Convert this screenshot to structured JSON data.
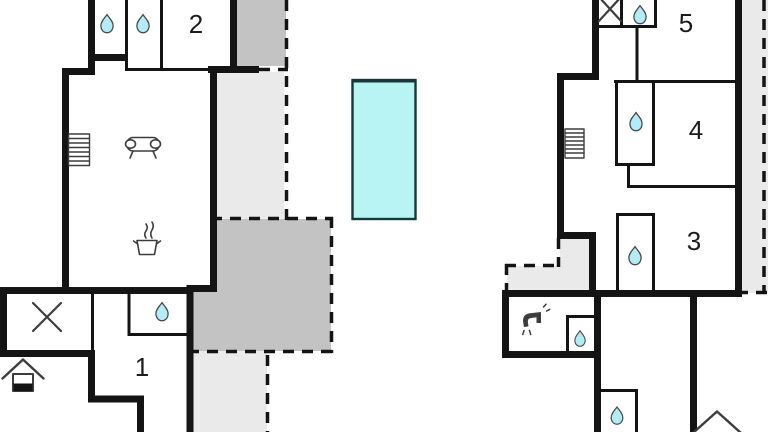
{
  "plan": {
    "rooms": [
      {
        "number": "1"
      },
      {
        "number": "2"
      },
      {
        "number": "3"
      },
      {
        "number": "4"
      },
      {
        "number": "5"
      }
    ],
    "icons": {
      "water-drop-icon": "teardrop (bath/shower)",
      "stairs-icon": "rectangle with rungs",
      "sofa-icon": "couch with round armrests",
      "stove-icon": "pot with steam",
      "cross-icon": "diagonal X mark",
      "faucet-icon": "water tap",
      "house-icon": "house with filled base (floor level)",
      "pool-icon": "cyan rectangle (swimming pool)"
    }
  },
  "colors": {
    "background": "#ffffff",
    "wall": "#141414",
    "gray_dark": "#c3c3c3",
    "gray_light": "#eaeaea",
    "water_fill": "#b3ecf5",
    "water_stroke": "#4a4a4a",
    "pool_fill": "#b9f4f4",
    "pool_stroke": "#16383a",
    "icon_stroke": "#3d3d3d",
    "label_color": "#1c1c1c"
  }
}
